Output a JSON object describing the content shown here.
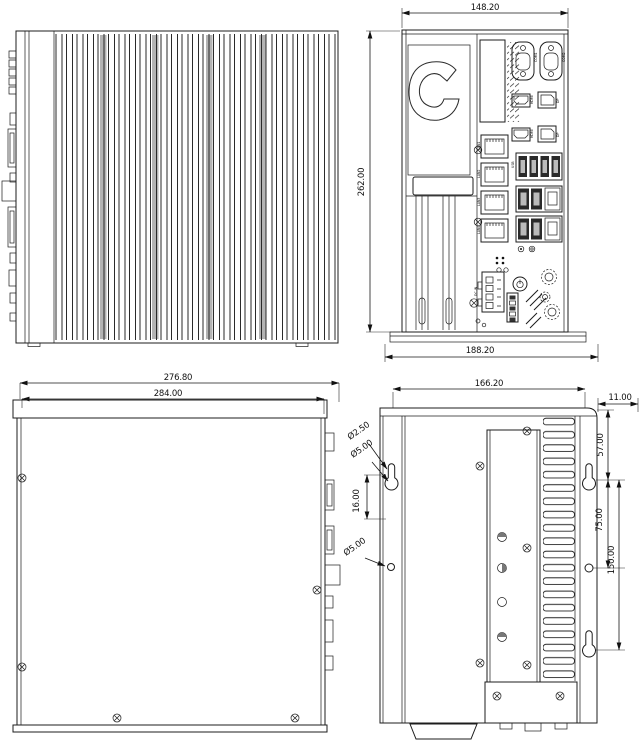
{
  "drawing": {
    "top_view": {
      "name": "top-view"
    },
    "front_view": {
      "dims": {
        "width": "148.20",
        "height": "262.00",
        "depth": "188.20"
      },
      "ports": {
        "com1": "COM1",
        "com2": "COM2",
        "hdmi1": "HDMI",
        "dp1": "DP",
        "hdmi2": "HDMI",
        "dp2": "DP",
        "lan1": "LAN1",
        "lan2": "LAN2",
        "lan3": "LAN3",
        "lan4": "LAN4",
        "usb": "USB",
        "dc_in": "DC-IN"
      }
    },
    "side_view": {
      "dims": {
        "overall_depth": "276.80",
        "body_depth": "284.00"
      }
    },
    "rear_view": {
      "dims": {
        "width": "166.20",
        "fin_depth": "11.00",
        "top_to_keyhole": "57.00",
        "keyhole_to_hole": "75.00",
        "keyhole_span": "150.00",
        "keyhole_slot_length": "16.00",
        "keyhole_slot_dia": "Ø2.50",
        "keyhole_dia": "Ø5.00",
        "hole_dia": "Ø5.00"
      }
    }
  }
}
